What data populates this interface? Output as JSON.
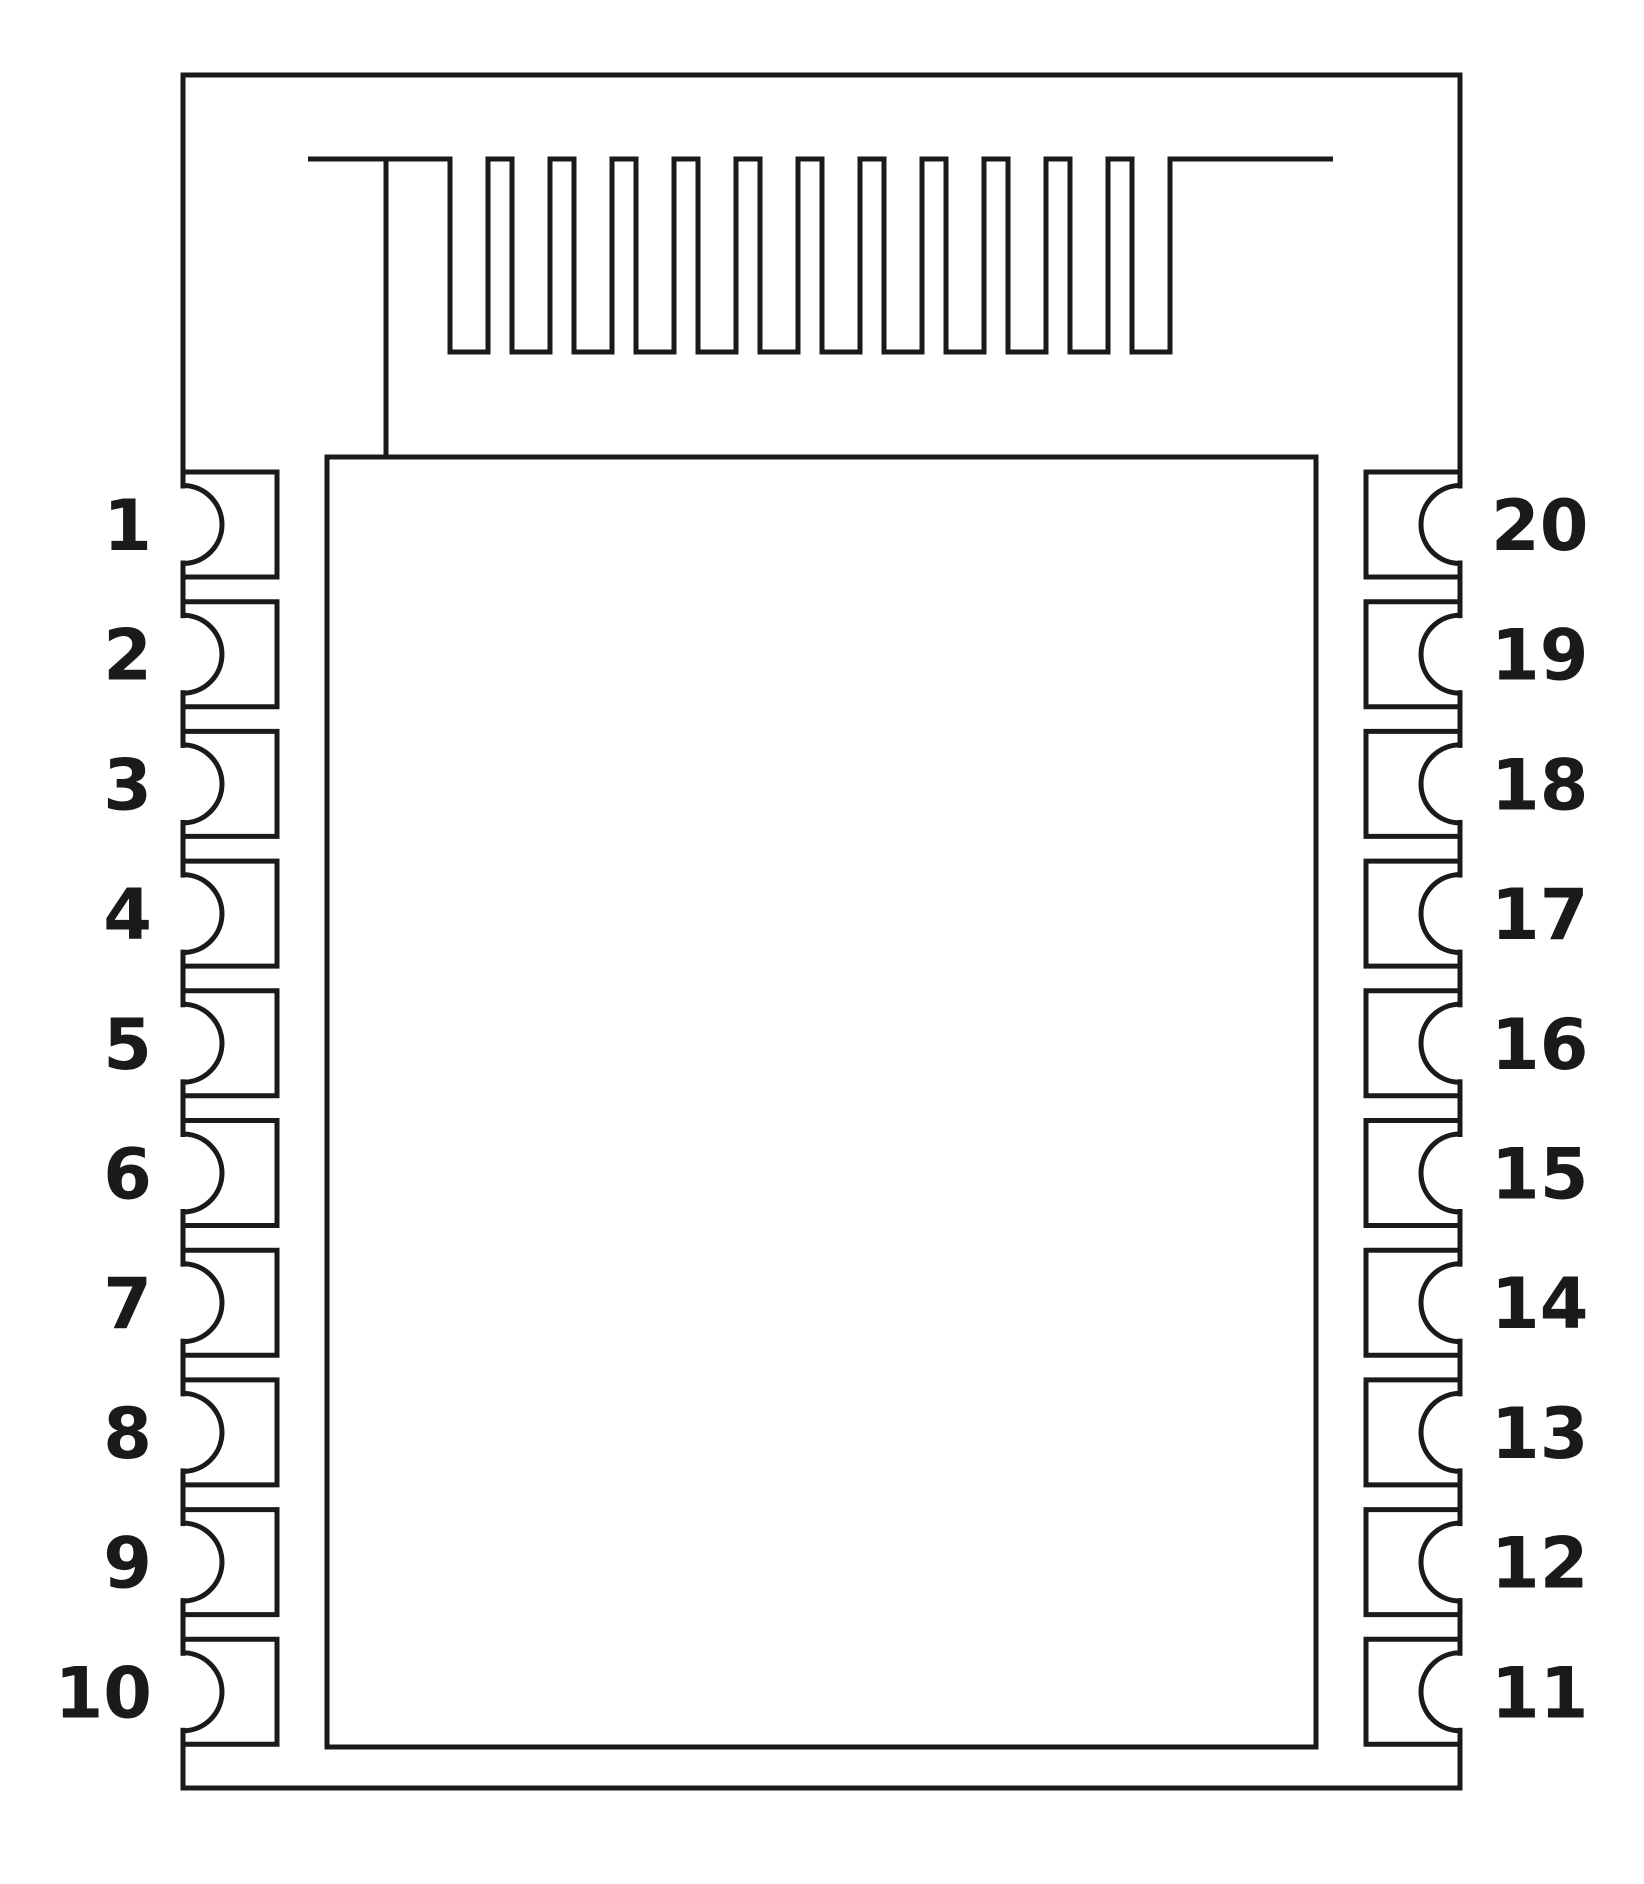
{
  "pins": {
    "left": [
      "1",
      "2",
      "3",
      "4",
      "5",
      "6",
      "7",
      "8",
      "9",
      "10"
    ],
    "right": [
      "20",
      "19",
      "18",
      "17",
      "16",
      "15",
      "14",
      "13",
      "12",
      "11"
    ]
  },
  "style": {
    "line_color": "#1a1a1a",
    "background_color": "#ffffff"
  }
}
